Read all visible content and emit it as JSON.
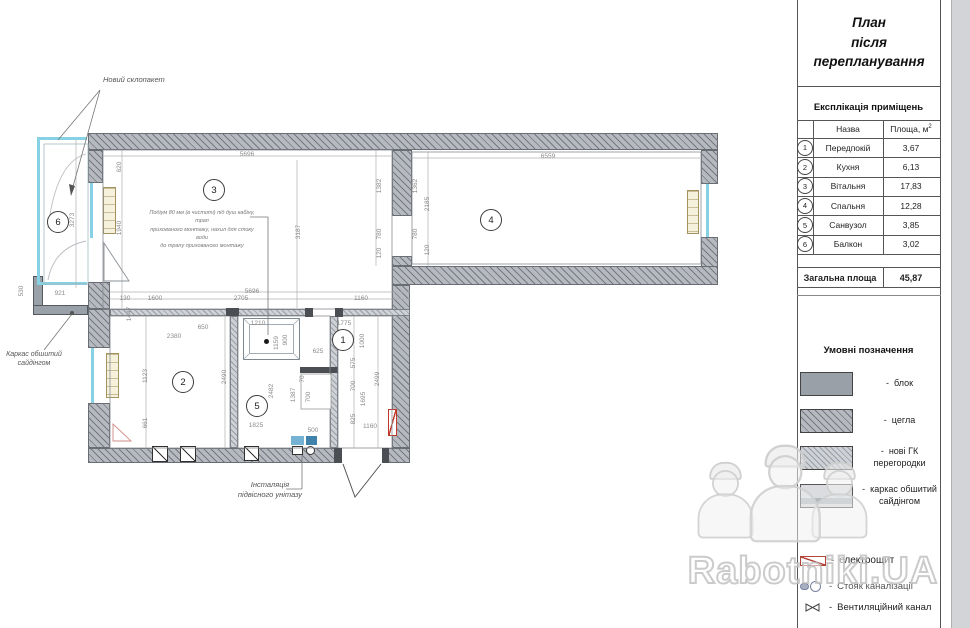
{
  "page": {
    "watermark": "Rabotniki.UA"
  },
  "title": {
    "lines": [
      "План",
      "після",
      "перепланування"
    ]
  },
  "explication": {
    "heading": "Експлікація приміщень",
    "col_name": "Назва",
    "col_area": "Площа, м",
    "col_area_sup": "2",
    "rows": [
      {
        "num": "1",
        "name": "Передпокій",
        "area": "3,67"
      },
      {
        "num": "2",
        "name": "Кухня",
        "area": "6,13"
      },
      {
        "num": "3",
        "name": "Вітальня",
        "area": "17,83"
      },
      {
        "num": "4",
        "name": "Спальня",
        "area": "12,28"
      },
      {
        "num": "5",
        "name": "Санвузол",
        "area": "3,85"
      },
      {
        "num": "6",
        "name": "Балкон",
        "area": "3,02"
      }
    ],
    "total_label": "Загальна площа",
    "total_value": "45,87"
  },
  "legend": {
    "heading": "Умовні позначення",
    "materials": [
      {
        "label": "блок",
        "type": "block"
      },
      {
        "label": "цегла",
        "type": "brick"
      },
      {
        "label": "нові ГК перегородки",
        "type": "gk"
      },
      {
        "label": "каркас обшитий сайдінгом",
        "type": "siding"
      }
    ],
    "symbols": [
      {
        "label": "електрощит",
        "icon": "electro-panel-icon"
      },
      {
        "label": "Стояк каналізації",
        "icon": "sewer-riser-icon"
      },
      {
        "label": "Вентиляційний канал",
        "icon": "vent-channel-icon"
      }
    ]
  },
  "plan": {
    "labels": {
      "glazing": "Новий склопакет",
      "siding": "Каркас обшитий сайдінгом",
      "toilet_lines": [
        "Інсталяція",
        "підвісного унітазу"
      ],
      "podium_lines": [
        "Подіум 80 мм (в чистоті) під душ кабіну, трап",
        "прихованого монтажу, нахил для стоку води",
        "до трапу прихованого монтажу"
      ]
    },
    "rooms": [
      {
        "num": "1",
        "x": 343,
        "y": 340
      },
      {
        "num": "2",
        "x": 183,
        "y": 382
      },
      {
        "num": "3",
        "x": 214,
        "y": 190
      },
      {
        "num": "4",
        "x": 491,
        "y": 220
      },
      {
        "num": "5",
        "x": 257,
        "y": 406
      },
      {
        "num": "6",
        "x": 58,
        "y": 222
      }
    ],
    "dims": [
      {
        "t": "5696",
        "x": 247,
        "y": 155
      },
      {
        "t": "6559",
        "x": 548,
        "y": 157
      },
      {
        "t": "620",
        "x": 120,
        "y": 167,
        "r": 1
      },
      {
        "t": "1940",
        "x": 120,
        "y": 228,
        "r": 1
      },
      {
        "t": "3273",
        "x": 73,
        "y": 220,
        "r": 1
      },
      {
        "t": "3187",
        "x": 299,
        "y": 232,
        "r": 1
      },
      {
        "t": "1382",
        "x": 380,
        "y": 186,
        "r": 1
      },
      {
        "t": "780",
        "x": 380,
        "y": 234,
        "r": 1
      },
      {
        "t": "120",
        "x": 380,
        "y": 253,
        "r": 1
      },
      {
        "t": "1362",
        "x": 416,
        "y": 186,
        "r": 1
      },
      {
        "t": "2185",
        "x": 428,
        "y": 204,
        "r": 1
      },
      {
        "t": "780",
        "x": 416,
        "y": 234,
        "r": 1
      },
      {
        "t": "120",
        "x": 428,
        "y": 250,
        "r": 1
      },
      {
        "t": "530",
        "x": 22,
        "y": 291,
        "r": 1
      },
      {
        "t": "921",
        "x": 60,
        "y": 294
      },
      {
        "t": "130",
        "x": 125,
        "y": 299
      },
      {
        "t": "1600",
        "x": 155,
        "y": 299
      },
      {
        "t": "5696",
        "x": 252,
        "y": 292
      },
      {
        "t": "2705",
        "x": 241,
        "y": 299
      },
      {
        "t": "1160",
        "x": 361,
        "y": 299
      },
      {
        "t": "1447",
        "x": 130,
        "y": 314,
        "r": 1
      },
      {
        "t": "2380",
        "x": 174,
        "y": 337
      },
      {
        "t": "650",
        "x": 203,
        "y": 328
      },
      {
        "t": "1210",
        "x": 258,
        "y": 324
      },
      {
        "t": "1123",
        "x": 146,
        "y": 376,
        "r": 1
      },
      {
        "t": "661",
        "x": 146,
        "y": 423,
        "r": 1
      },
      {
        "t": "2490",
        "x": 225,
        "y": 377,
        "r": 1
      },
      {
        "t": "1159",
        "x": 277,
        "y": 343,
        "r": 1
      },
      {
        "t": "900",
        "x": 286,
        "y": 340,
        "r": 1
      },
      {
        "t": "2482",
        "x": 272,
        "y": 391,
        "r": 1
      },
      {
        "t": "1387",
        "x": 294,
        "y": 395,
        "r": 1
      },
      {
        "t": "1825",
        "x": 256,
        "y": 426
      },
      {
        "t": "500",
        "x": 313,
        "y": 431
      },
      {
        "t": "70",
        "x": 303,
        "y": 379,
        "r": 1
      },
      {
        "t": "700",
        "x": 309,
        "y": 397,
        "r": 1
      },
      {
        "t": "1775",
        "x": 344,
        "y": 324
      },
      {
        "t": "1000",
        "x": 363,
        "y": 341,
        "r": 1
      },
      {
        "t": "625",
        "x": 318,
        "y": 352
      },
      {
        "t": "575",
        "x": 354,
        "y": 363,
        "r": 1
      },
      {
        "t": "700",
        "x": 354,
        "y": 386,
        "r": 1
      },
      {
        "t": "1695",
        "x": 364,
        "y": 399,
        "r": 1
      },
      {
        "t": "825",
        "x": 354,
        "y": 419,
        "r": 1
      },
      {
        "t": "2499",
        "x": 378,
        "y": 379,
        "r": 1
      },
      {
        "t": "1160",
        "x": 370,
        "y": 427
      }
    ]
  }
}
